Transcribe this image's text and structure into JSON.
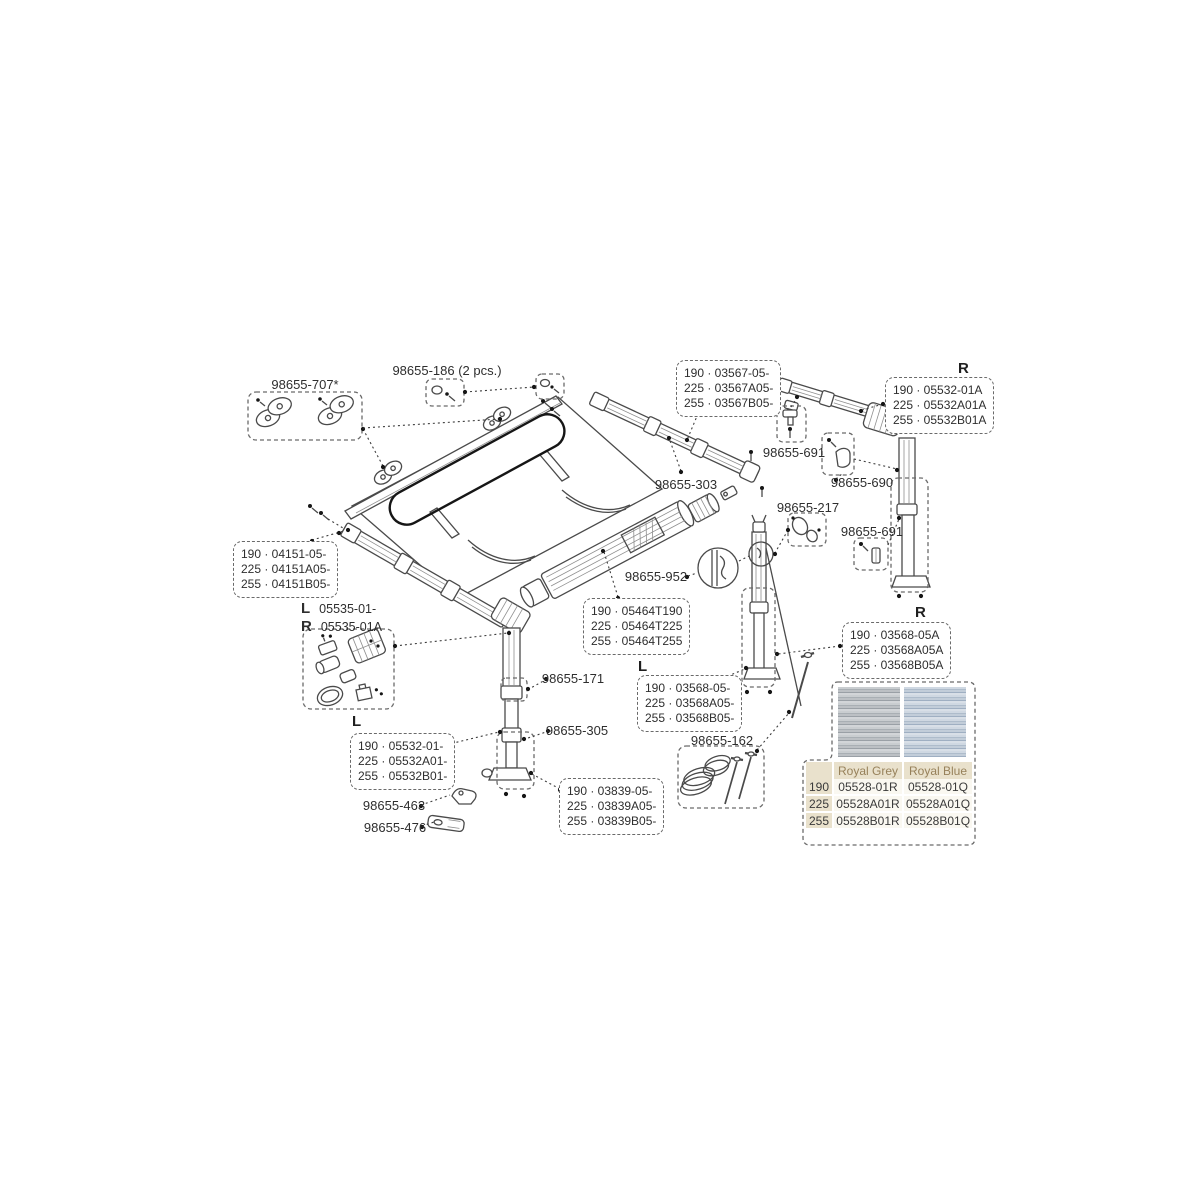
{
  "part_labels": {
    "p707": "98655-707*",
    "p186": "98655-186 (2 pcs.)",
    "p303": "98655-303",
    "p691_top": "98655-691",
    "p690": "98655-690",
    "p217": "98655-217",
    "p691_bottom": "98655-691",
    "p952": "98655-952",
    "p171": "98655-171",
    "p305": "98655-305",
    "p463": "98655-463",
    "p476": "98655-476",
    "p162": "98655-162"
  },
  "code_boxes": {
    "b04151": {
      "lines": [
        "190 · 04151-05-",
        "225 · 04151A05-",
        "255 · 04151B05-"
      ]
    },
    "b03567": {
      "lines": [
        "190 · 03567-05-",
        "225 · 03567A05-",
        "255 · 03567B05-"
      ]
    },
    "b05532R": {
      "side": "R",
      "lines": [
        "190 · 05532-01A",
        "225 · 05532A01A",
        "255 · 05532B01A"
      ]
    },
    "b05464": {
      "lines": [
        "190 · 05464T190",
        "225 · 05464T225",
        "255 · 05464T255"
      ]
    },
    "b03568L": {
      "side": "L",
      "lines": [
        "190 · 03568-05-",
        "225 · 03568A05-",
        "255 · 03568B05-"
      ]
    },
    "b03568R": {
      "side": "R",
      "lines": [
        "190 · 03568-05A",
        "225 · 03568A05A",
        "255 · 03568B05A"
      ]
    },
    "b05532L": {
      "side": "L",
      "lines": [
        "190 · 05532-01-",
        "225 · 05532A01-",
        "255 · 05532B01-"
      ]
    },
    "b03839": {
      "lines": [
        "190 · 03839-05-",
        "225 · 03839A05-",
        "255 · 03839B05-"
      ]
    },
    "b05535": {
      "left_side": "L",
      "left_code": "05535-01-",
      "right_side": "R",
      "right_code": "05535-01A"
    }
  },
  "fabric_table": {
    "col_headers": [
      "Royal Grey",
      "Royal Blue"
    ],
    "rows": [
      {
        "size": "190",
        "grey": "05528-01R",
        "blue": "05528-01Q"
      },
      {
        "size": "225",
        "grey": "05528A01R",
        "blue": "05528A01Q"
      },
      {
        "size": "255",
        "grey": "05528B01R",
        "blue": "05528B01Q"
      }
    ],
    "swatches": [
      {
        "name": "Royal Grey",
        "color_light": "#c9cdd0",
        "color_dark": "#9aa0a6"
      },
      {
        "name": "Royal Blue",
        "color_light": "#cfd8e2",
        "color_dark": "#9fafc2"
      }
    ]
  },
  "colors": {
    "background": "#ffffff",
    "line_art": "#4a4a4a",
    "label_text": "#2e2e2e",
    "table_header_bg": "#e9e1cc",
    "table_header_text": "#97815a",
    "table_cell_bg": "#faf8f1",
    "table_cell_text": "#3a3a3a"
  }
}
